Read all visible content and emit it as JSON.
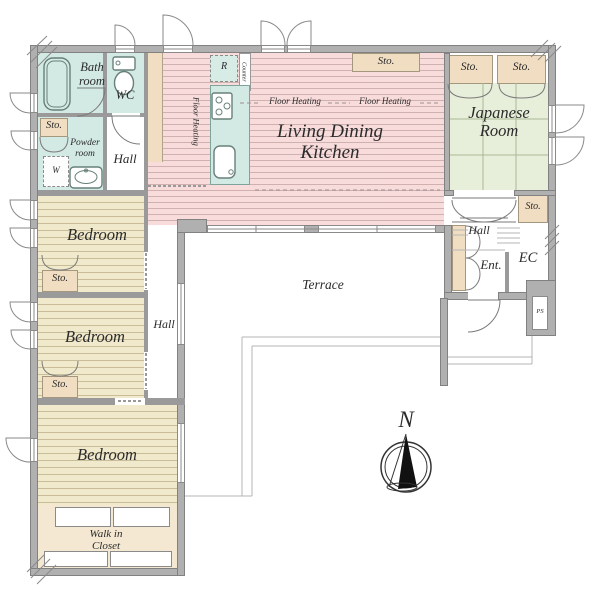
{
  "plan_type": "residential-floor-plan",
  "colors": {
    "wall": "#b0b0b0",
    "wall_edge": "#818181",
    "wet_area": "#d3e9e3",
    "storage": "#f1dec2",
    "ldk_floor": "#f7dcdb",
    "tatami": "#e7eed9",
    "bedroom_floor": "#f1e9cb",
    "closet_floor": "#f4e8d2",
    "text": "#2b2b2b"
  },
  "rooms": {
    "bath": {
      "line1": "Bath",
      "line2": "room"
    },
    "wc": {
      "label": "WC"
    },
    "powder": {
      "line1": "Powder",
      "line2": "room"
    },
    "washer": {
      "label": "W"
    },
    "hall_west": {
      "label": "Hall"
    },
    "ldk": {
      "line1": "Living Dining",
      "line2": "Kitchen"
    },
    "japanese": {
      "line1": "Japanese",
      "line2": "Room"
    },
    "bedroom_1": {
      "label": "Bedroom"
    },
    "bedroom_2": {
      "label": "Bedroom"
    },
    "bedroom_3": {
      "label": "Bedroom"
    },
    "walk_in_closet": {
      "line1": "Walk in",
      "line2": "Closet"
    },
    "terrace": {
      "label": "Terrace"
    },
    "hall_center": {
      "label": "Hall"
    },
    "hall_entrance": {
      "label": "Hall"
    },
    "entrance": {
      "label": "Ent."
    },
    "entrance_closet": {
      "label": "EC"
    },
    "pipe_shaft": {
      "label": "PS"
    }
  },
  "kitchen": {
    "fridge": "R",
    "counter": "Counter",
    "floor_heating_left": "Floor Heating",
    "floor_heating_mid": "Floor Heating",
    "floor_heating_right": "Floor Heating"
  },
  "storages": {
    "powder_side": "Sto.",
    "ldk": "Sto.",
    "japanese_left": "Sto.",
    "japanese_right": "Sto.",
    "japanese_south": "Sto.",
    "bedroom_1": "Sto.",
    "bedroom_2": "Sto."
  },
  "compass": {
    "north": "N"
  }
}
